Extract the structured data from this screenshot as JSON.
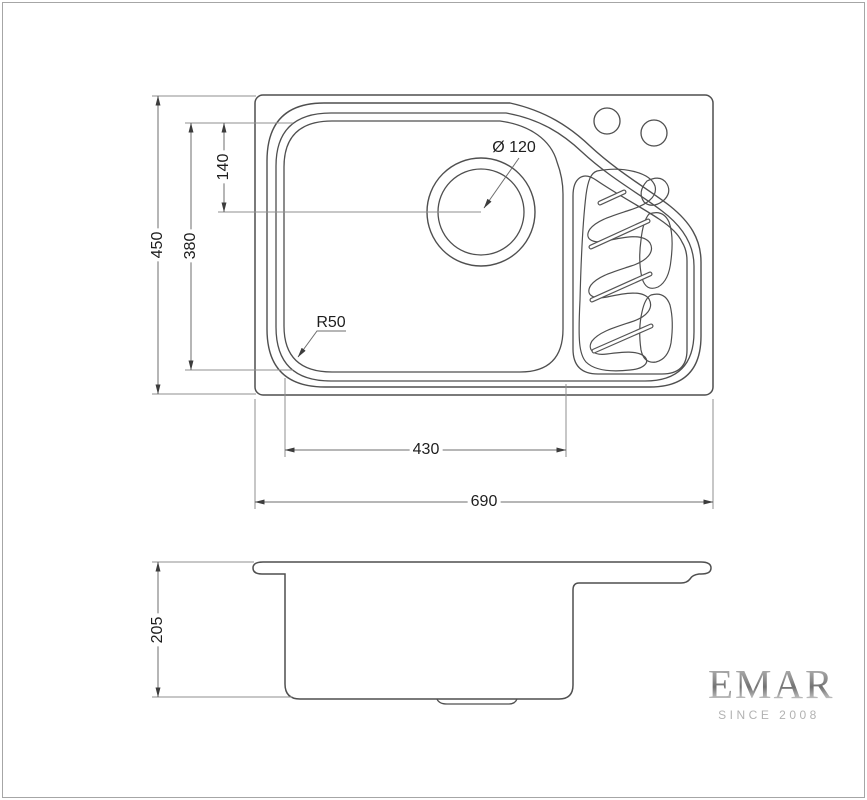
{
  "title": "Sink technical drawing",
  "dimensions": {
    "overall_depth": "450",
    "bowl_depth": "380",
    "drain_offset": "140",
    "drain_diameter": "Ø 120",
    "corner_radius": "R50",
    "bowl_width": "430",
    "overall_width": "690",
    "side_height": "205"
  },
  "logo": {
    "brand": "EMAR",
    "tagline": "SINCE 2008"
  },
  "colors": {
    "object_line": "#4f4f4f",
    "thin_line": "#5a5a5a",
    "dimension_line": "#8f8f8f",
    "text": "#1e1e1e",
    "logo_silver": "#8d8d8d",
    "background": "#ffffff",
    "frame": "#a6a6a6"
  }
}
